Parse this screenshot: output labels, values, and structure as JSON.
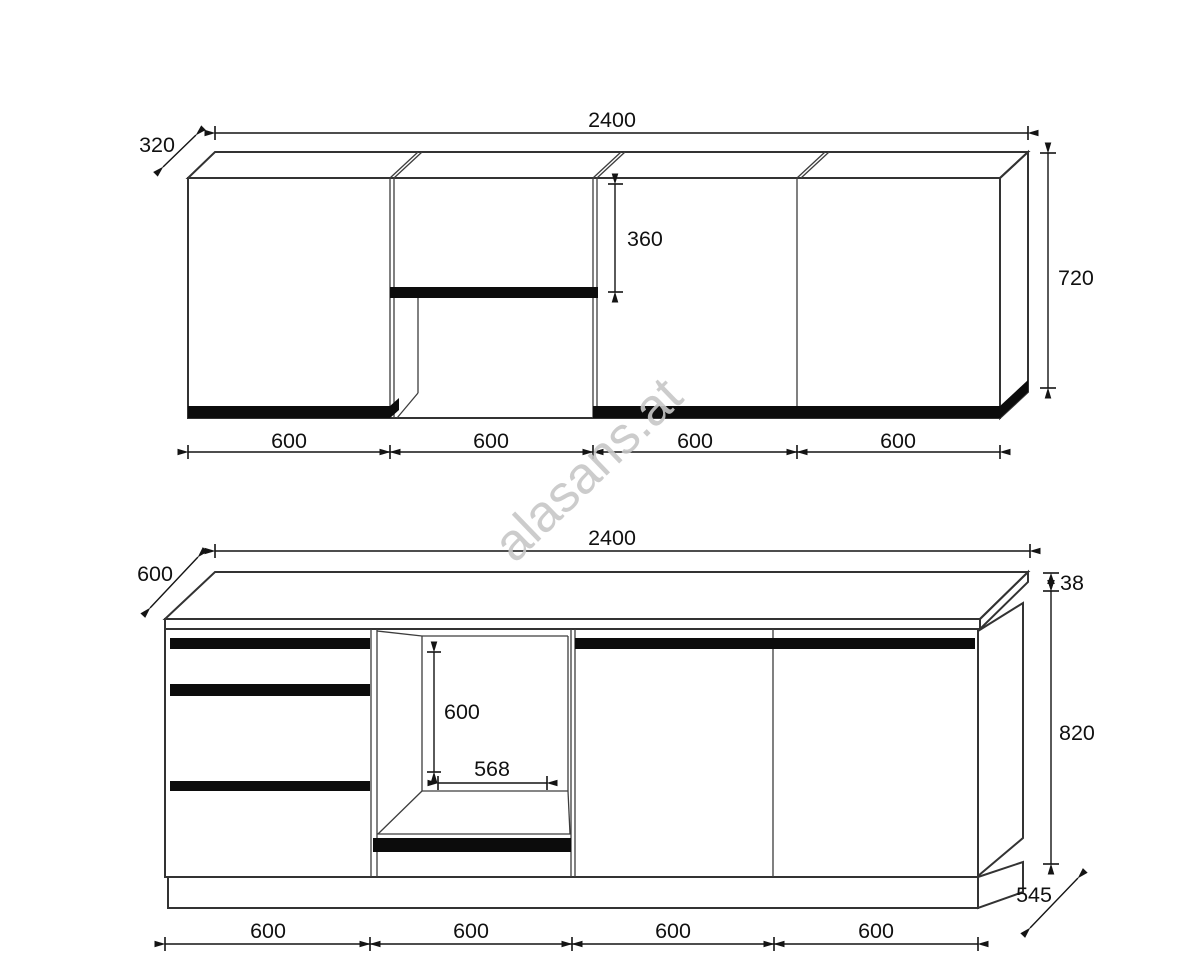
{
  "watermark": "alasans.at",
  "upper_view": {
    "total_width": "2400",
    "depth": "320",
    "open_shelf_height": "360",
    "cabinet_height": "720",
    "section_widths": [
      "600",
      "600",
      "600",
      "600"
    ]
  },
  "lower_view": {
    "total_width": "2400",
    "worktop_depth": "600",
    "worktop_thickness": "38",
    "cabinet_height": "820",
    "base_depth": "545",
    "niche_height": "600",
    "niche_width": "568",
    "section_widths": [
      "600",
      "600",
      "600",
      "600"
    ]
  }
}
